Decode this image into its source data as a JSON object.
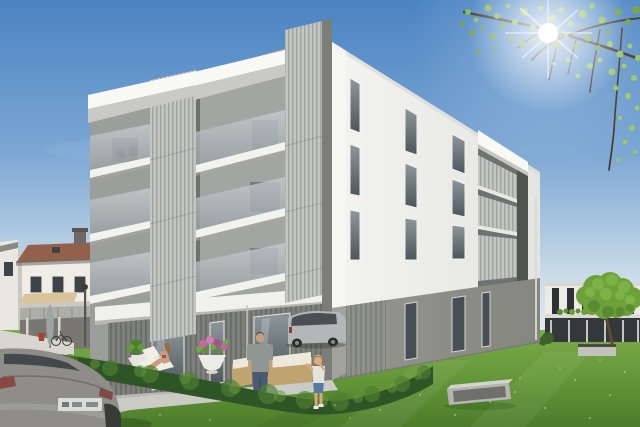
{
  "scene": {
    "type": "architectural-3d-rendering",
    "description": "Sunny exterior visualization of a modern four-storey apartment building with white upper floors, an anthracite corrugated ground floor, stacked balconies with vertical metal slat screens and frosted glass balustrades. A family (sunbathing woman, standing man, small boy) occupies the garden terrace behind a low hedge. Neighbouring houses, parked cars, a lawn with a concrete bench and a sunlit tree branch frame the scene.",
    "time_of_day": "bright sunny day",
    "sun_position": "upper right behind tree branches"
  },
  "main_building": {
    "floors": 4,
    "upper_floors_finish": "white render",
    "ground_floor_finish": "grey corrugated metal cladding",
    "balcony_stacks_front": 2,
    "side_loggia_levels": 3,
    "balcony_screen": "vertical metal slats",
    "balustrade": "frosted glass",
    "side_window_columns": 3,
    "ground_floor_glass_doors": 3
  },
  "surroundings": {
    "left": [
      "gabled neighbour house with red-brown roof",
      "awning and concrete balcony",
      "carport with umbrella and bicycles",
      "street lamp",
      "retaining wall"
    ],
    "right": [
      "modern white row building with dark window strips",
      "dark carport band",
      "deciduous tree",
      "concrete planter"
    ],
    "foreground": [
      "trimmed hedge",
      "lawn with daisies",
      "concrete frame bench",
      "paved driveway"
    ]
  },
  "people": [
    {
      "name": "woman-sunbathing",
      "pose": "sitting on white lounger"
    },
    {
      "name": "man-standing",
      "clothing": "grey t-shirt, jeans"
    },
    {
      "name": "boy",
      "clothing": "light shirt, denim shorts"
    }
  ],
  "vehicles": [
    {
      "name": "foreground-car",
      "color": "grey",
      "view": "rear, bottom-left, license plate illegible"
    },
    {
      "name": "parked-minivan",
      "color": "silver",
      "position": "beside building corner"
    }
  ],
  "furniture": [
    {
      "name": "loungers",
      "count": 2
    },
    {
      "name": "wicker-sofa-set",
      "count": 2
    },
    {
      "name": "side-table",
      "count": 1
    },
    {
      "name": "flower-planter",
      "flowers": "pink and purple"
    }
  ],
  "colors": {
    "sky_top": "#4a83c2",
    "sky_mid": "#7ea8d4",
    "sky_low": "#c9dbe7",
    "sky_horizon": "#e9eef0",
    "sun": "#ffffff",
    "leaf_bright": "#9ccd58",
    "leaf_mid": "#85bb44",
    "leaf_dark": "#6ba133",
    "branch": "#3f3322",
    "facade_light": "#f3f3f1",
    "facade_shaded": "#e4e4e0",
    "facade_corner": "#f6f6f3",
    "roof_slab": "#f8f8f5",
    "soffit_shadow": "#c9c9c5",
    "slat_base": "#bfc1bf",
    "slat_stripe": "#a3a5a3",
    "glass_light": "#c8cdd0",
    "glass_dark": "#98a1a5",
    "window_light": "#8d979c",
    "window_dark": "#4c565b",
    "ground_window": "#474f54",
    "base_light": "#95978f",
    "base_dark": "#84867f",
    "corr_base": "#8f918d",
    "corr_stripe": "#7e807c",
    "corr_dark_base": "#7e807b",
    "corr_dark_stripe": "#6c6e6a",
    "corner_shadow": "#7b7d78",
    "lawn_light": "#7cab49",
    "lawn_mid": "#66993a",
    "lawn_dark": "#4d7d2b",
    "hedge_dark": "#2f5526",
    "hedge_mid": "#4e7f31",
    "hedge_light": "#63983e",
    "pavement_light": "#c6c6c0",
    "pavement_dark": "#b2b2ac",
    "terrace_floor": "#cbcbc5",
    "neighbor_wall": "#f0ede7",
    "neighbor_roof": "#93604b",
    "awning": "#d9c49a",
    "balcony_rail": "#aeaea8",
    "carport_shadow": "#787771",
    "wall_retaining": "#d7d6d0",
    "bg_wall": "#edebe7",
    "bg_window": "#2c3136",
    "garage_band": "#34383b",
    "planter_concrete": "#c2c2bc",
    "bg_tree_mid": "#6da23a",
    "bg_tree_light": "#82b84c",
    "bg_tree_dark": "#4f7c2a",
    "trunk": "#5f4a34",
    "car_fg_body": "#8e8d89",
    "car_fg_window": "#43484a",
    "plate": "#dcddd8",
    "taillight": "#8a3c38",
    "van_body": "#b4b7b8",
    "van_window": "#3e4448",
    "bench_front": "#b4b5b0",
    "bench_top": "#d3d4cf",
    "bench_inner": "#6f706b",
    "skin": "#caa07c",
    "jeans": "#4a5a70",
    "shirt_man": "#909694",
    "shorts_boy": "#5878a4",
    "shirt_boy": "#e4e2da",
    "hair_blond": "#e0c070",
    "wicker": "#c0a470",
    "cushion": "#ece8dc",
    "umbrella": "#9da4a4",
    "lamp": "#55554f",
    "distant_hedge": "#6d8a52",
    "flower_pink": "#c06a9a",
    "flower_light": "#cf7fae",
    "flower_deep": "#a8548a",
    "plant_green": "#4e7f31"
  }
}
